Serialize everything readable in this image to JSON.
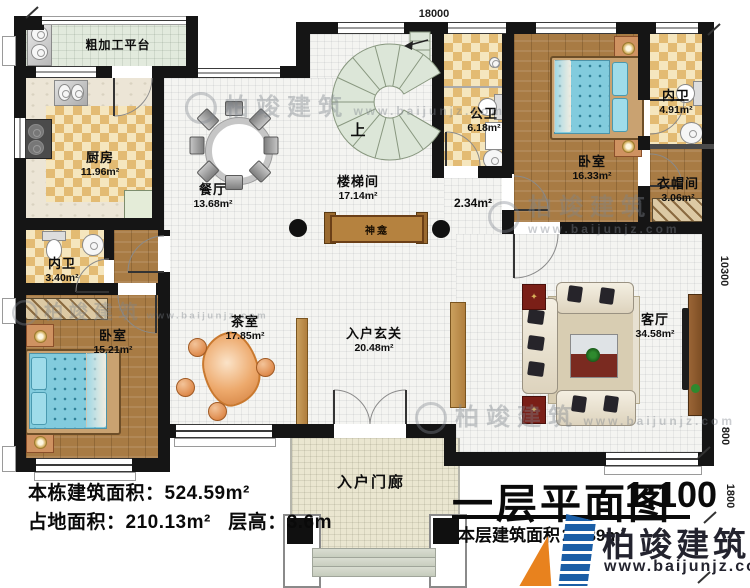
{
  "plan": {
    "dims": {
      "top": "18000",
      "right": "10300",
      "r800": "800",
      "r1800": "1800"
    },
    "rooms": {
      "rough_platform": {
        "name": "粗加工平台"
      },
      "kitchen": {
        "name": "厨房",
        "area": "11.96m²"
      },
      "dining": {
        "name": "餐厅",
        "area": "13.68m²"
      },
      "stairwell": {
        "name": "楼梯间",
        "area": "17.14m²"
      },
      "public_bath": {
        "name": "公卫",
        "area": "6.18m²"
      },
      "bedroom_right": {
        "name": "卧室",
        "area": "16.33m²"
      },
      "ensuite_right": {
        "name": "内卫",
        "area": "4.91m²"
      },
      "cloakroom": {
        "name": "衣帽间",
        "area": "3.06m²"
      },
      "ensuite_left": {
        "name": "内卫",
        "area": "3.40m²"
      },
      "bedroom_left": {
        "name": "卧室",
        "area": "15.21m²"
      },
      "tea_room": {
        "name": "茶室",
        "area": "17.85m²"
      },
      "foyer": {
        "name": "入户玄关",
        "area": "20.48m²"
      },
      "living": {
        "name": "客厅",
        "area": "34.58m²"
      },
      "porch": {
        "name": "入户门廊"
      },
      "shrine": {
        "name": "神龛"
      }
    },
    "labels": {
      "up": "上",
      "hall_small_area": "2.34m²"
    }
  },
  "stats": {
    "building_area": "本栋建筑面积：524.59m²",
    "footprint": "占地面积：210.13m²",
    "floor_height": "层高：3.6m"
  },
  "title": {
    "main": "一层平面图",
    "scale": "1:100",
    "floor_area_label": "本层建筑面积：",
    "floor_area_value": "189",
    "floor_area_unit": "m²"
  },
  "brand": {
    "name": "柏竣建筑",
    "url": "www.baijunjz.com"
  },
  "watermark": {
    "name": "柏竣建筑",
    "url": "www.baijunjz.com"
  },
  "colors": {
    "wall": "#151515",
    "checker": "#e3bb73",
    "wood": "#a87b44",
    "bed": "#82cbdd",
    "stair": "#dce6d8",
    "porch": "#eae6d0",
    "brand_blue": "#1b5ea6",
    "brand_orange": "#e8821e",
    "logo_text": "#23232e"
  }
}
